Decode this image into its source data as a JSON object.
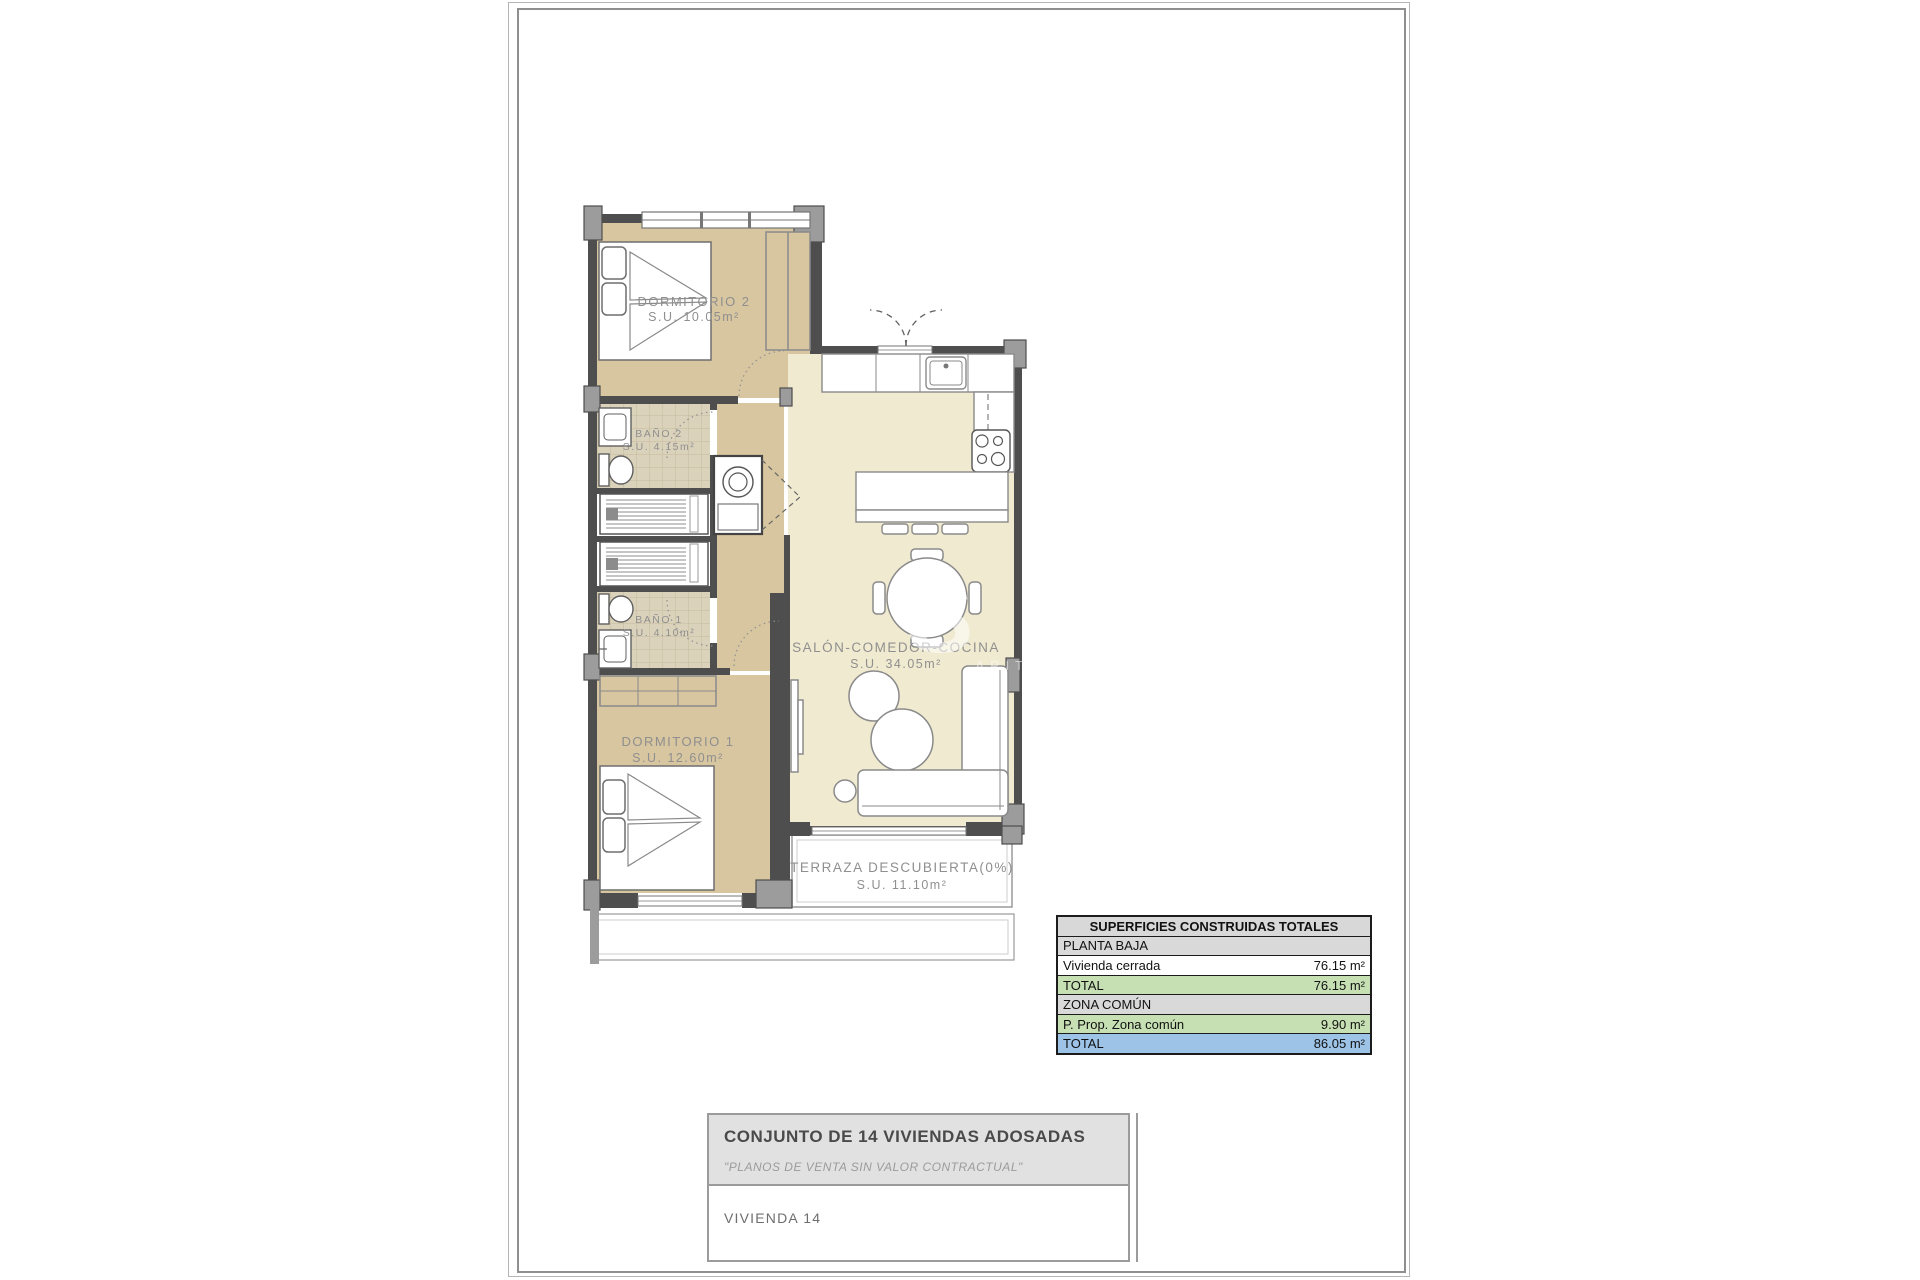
{
  "plan": {
    "rooms": [
      {
        "name": "DORMITORIO 2",
        "area": "S.U. 10.05m²"
      },
      {
        "name": "BAÑO 2",
        "area": "S.U. 4.15m²"
      },
      {
        "name": "BAÑO 1",
        "area": "S.U. 4.10m²"
      },
      {
        "name": "DORMITORIO 1",
        "area": "S.U. 12.60m²"
      },
      {
        "name": "SALÓN-COMEDOR-COCINA",
        "area": "S.U. 34.05m²"
      },
      {
        "name": "TERRAZA DESCUBIERTA(0%)",
        "area": "S.U. 11.10m²"
      }
    ],
    "watermark": {
      "line1": "S H",
      "line2": "ARITY HO"
    },
    "fixture_icons": [
      "bed-icon",
      "wardrobe-icon",
      "washbasin-icon",
      "toilet-icon",
      "shower-icon",
      "washing-machine-icon",
      "kitchen-sink-icon",
      "stove-icon",
      "dining-table-icon",
      "chair-icon",
      "armchair-icon",
      "sofa-icon",
      "tv-unit-icon",
      "breakfast-bar-icon",
      "stool-icon"
    ],
    "colors": {
      "bedroom_fill": "#d8c6a0",
      "salon_fill": "#f0ead0",
      "tile_fill": "#dbd2bc",
      "wall": "#4e4e4e",
      "pier": "#9c9c9c",
      "label_text": "#8f8f8f"
    }
  },
  "areas_table": {
    "title": "SUPERFICIES CONSTRUIDAS TOTALES",
    "rows": [
      {
        "label": "PLANTA BAJA",
        "value": ""
      },
      {
        "label": "Vivienda cerrada",
        "value": "76.15 m²"
      },
      {
        "label": "TOTAL",
        "value": "76.15 m²"
      },
      {
        "label": "ZONA COMÚN",
        "value": ""
      },
      {
        "label": "P. Prop. Zona común",
        "value": "9.90 m²"
      },
      {
        "label": "TOTAL",
        "value": "86.05 m²"
      }
    ],
    "colors": {
      "section": "#d9d9d9",
      "subtotal": "#c6e0b4",
      "total": "#9dc3e6"
    }
  },
  "title_block": {
    "project": "CONJUNTO DE 14 VIVIENDAS ADOSADAS",
    "disclaimer": "\"PLANOS DE VENTA SIN VALOR CONTRACTUAL\"",
    "unit": "VIVIENDA 14"
  }
}
